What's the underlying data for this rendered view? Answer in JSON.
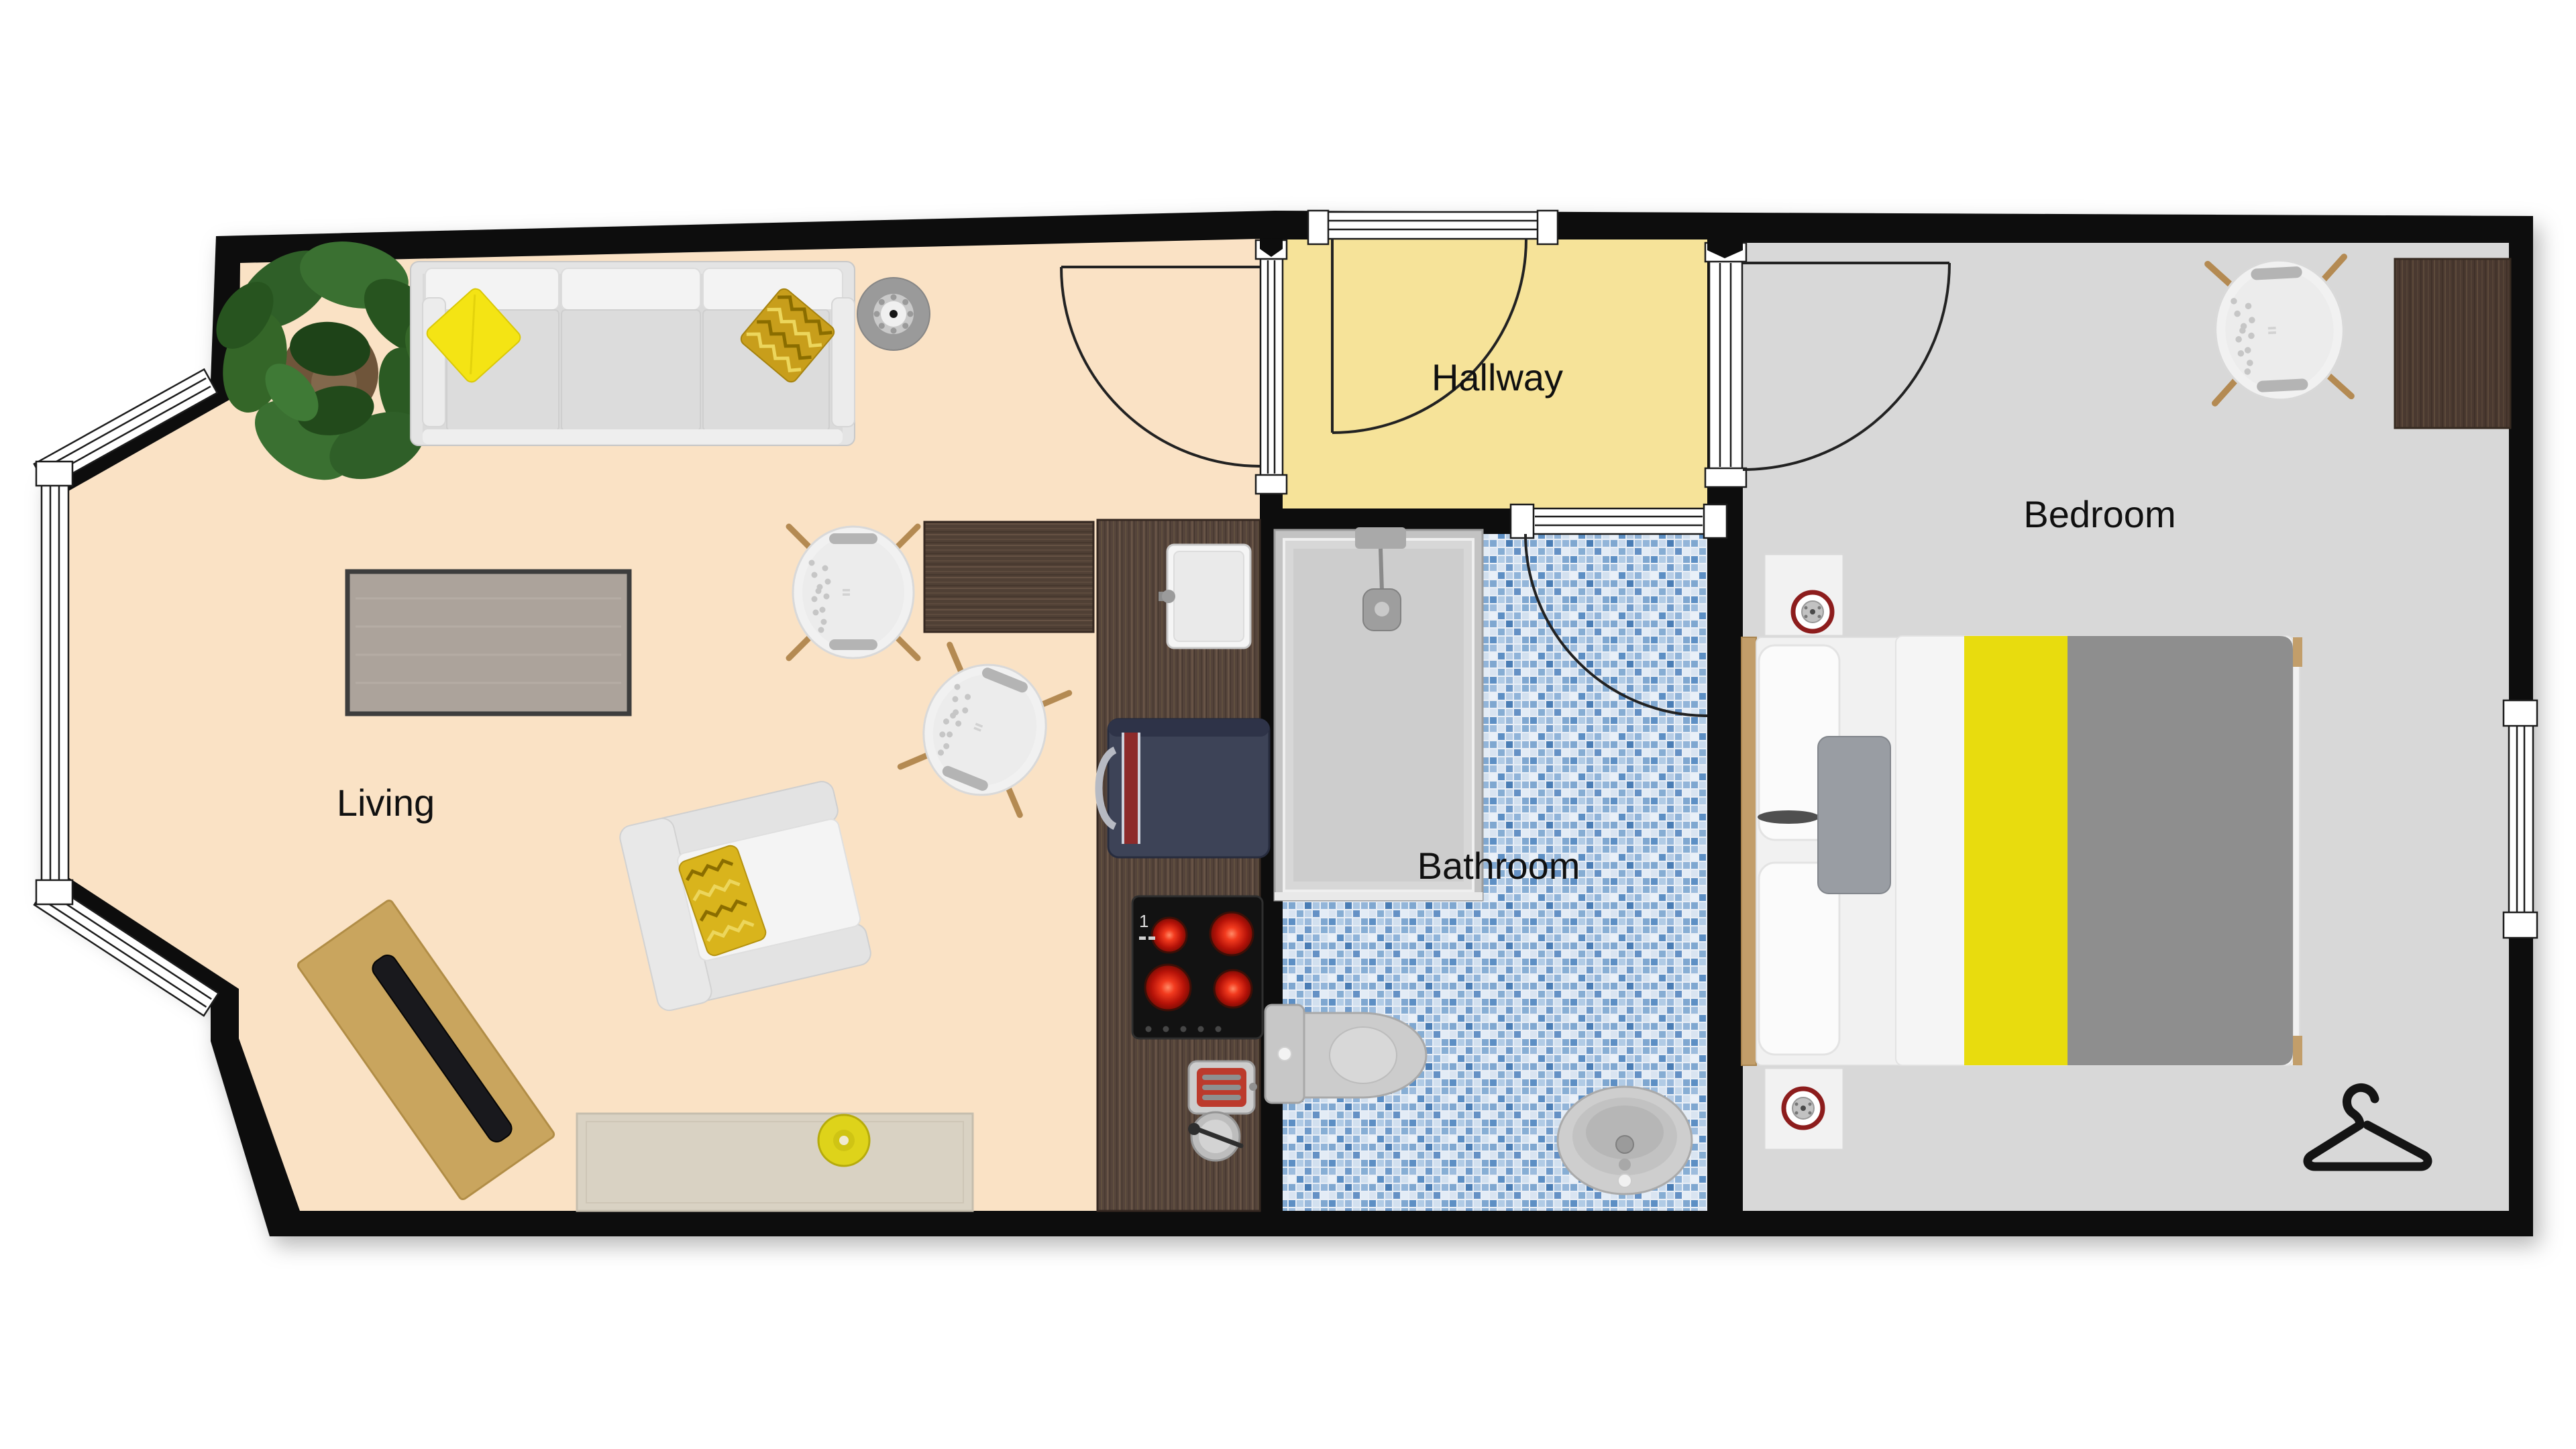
{
  "plan": {
    "type": "apartment-floor-plan-top-view",
    "rooms": {
      "living": {
        "label": "Living",
        "floor_color": "#fae2c5"
      },
      "hallway": {
        "label": "Hallway",
        "floor_color": "#f6e399"
      },
      "bathroom": {
        "label": "Bathroom",
        "tile_palette": [
          "#e9f0f8",
          "#b7cde6",
          "#87aed4",
          "#5d8fc4",
          "#6f9aca",
          "#4a7db5",
          "#c3d6ea",
          "#9dbcdd"
        ]
      },
      "bedroom": {
        "label": "Bedroom",
        "floor_color": "#d8d8d8"
      }
    },
    "walls": {
      "color": "#0d0d0d",
      "window_frame": "#ffffff"
    },
    "kitchen": {
      "stove_marking": "1"
    },
    "accents": {
      "pillow_yellow": "#f4e414",
      "chevron_gold": "#c89e1b",
      "bed_runner_yellow": "#e8dc0e",
      "blanket_gray": "#8e8e8e",
      "vase_yellow": "#ded31a",
      "wood_walnut": "#55443b",
      "wood_oak": "#c9a55e",
      "clock_ring_red": "#8d1d1d",
      "burner_red": "#d92313",
      "mixer_navy": "#3d4357"
    },
    "icons": [
      "sofa",
      "plant",
      "side-table",
      "coffee-table",
      "dining-table",
      "shell-chair",
      "kitchen-counter",
      "kitchen-sink",
      "stand-mixer",
      "cooktop",
      "toaster",
      "utensil-bowl",
      "armchair",
      "writing-desk",
      "laptop",
      "sideboard",
      "vase",
      "shower",
      "toilet",
      "washbasin",
      "bed",
      "nightstand",
      "alarm-clock",
      "bedroom-desk",
      "clothes-hanger",
      "door-swing",
      "window",
      "bay-window"
    ]
  }
}
